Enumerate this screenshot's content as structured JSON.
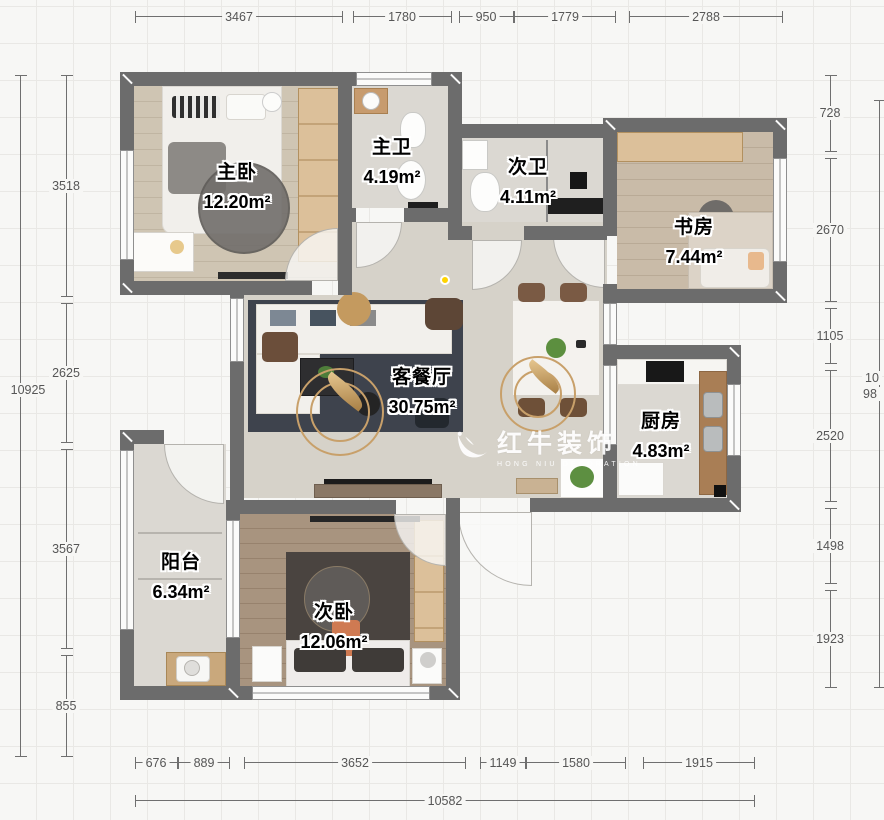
{
  "watermark": {
    "brand": "红牛装饰",
    "subtitle": "HONG NIU DECORATION",
    "logo": "bull-logo"
  },
  "rooms": [
    {
      "id": "master-bedroom",
      "name": "主卧",
      "area": "12.20m²"
    },
    {
      "id": "master-bath",
      "name": "主卫",
      "area": "4.19m²"
    },
    {
      "id": "second-bath",
      "name": "次卫",
      "area": "4.11m²"
    },
    {
      "id": "study",
      "name": "书房",
      "area": "7.44m²"
    },
    {
      "id": "living-dining",
      "name": "客餐厅",
      "area": "30.75m²"
    },
    {
      "id": "kitchen",
      "name": "厨房",
      "area": "4.83m²"
    },
    {
      "id": "balcony",
      "name": "阳台",
      "area": "6.34m²"
    },
    {
      "id": "second-bedroom",
      "name": "次卧",
      "area": "12.06m²"
    }
  ],
  "dimensions": {
    "top": [
      "3467",
      "1780",
      "950",
      "1779",
      "2788"
    ],
    "left_total": "10925",
    "left": [
      "3518",
      "2625",
      "3567",
      "855"
    ],
    "right": [
      "728",
      "2670",
      "1105",
      "2520",
      "1498",
      "1923"
    ],
    "right_clipped": [
      "10",
      "98"
    ],
    "bottom": [
      "676",
      "889",
      "3652",
      "1149",
      "1580",
      "1915"
    ],
    "bottom_total": "10582"
  },
  "colors": {
    "wall": "#6c6c6c",
    "dim_text": "#565656",
    "accent_marker": "#ffd400",
    "watermark": "#ffffff"
  }
}
